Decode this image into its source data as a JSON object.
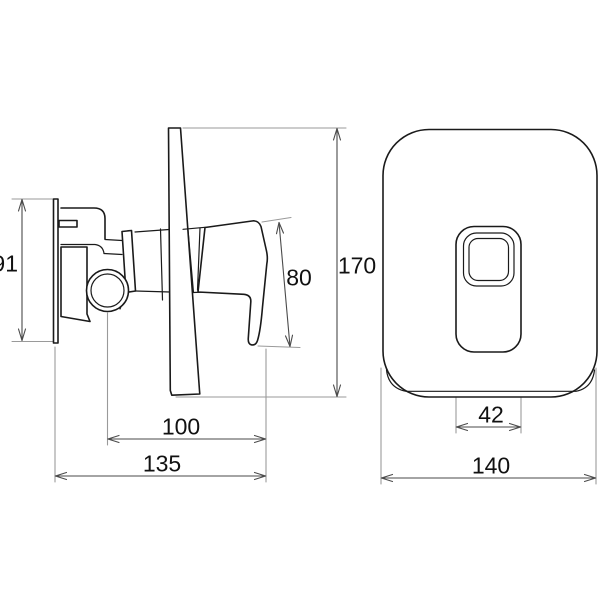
{
  "drawing": {
    "type": "technical-dimension-drawing",
    "subject": "concealed single-lever shower mixer, side view and front cover-plate view",
    "colors": {
      "background": "#ffffff",
      "part_outline": "#1a1a1a",
      "dimension_line": "#4a4a4a",
      "extension_line": "#9a9a9a",
      "label_text": "#111111"
    },
    "side_view": {
      "dimensions": {
        "body_height": "91",
        "handle_length": "80",
        "plate_height": "170",
        "handle_reach": "100",
        "total_depth": "135"
      }
    },
    "front_view": {
      "dimensions": {
        "handle_hub_width": "42",
        "plate_width": "140"
      }
    }
  }
}
